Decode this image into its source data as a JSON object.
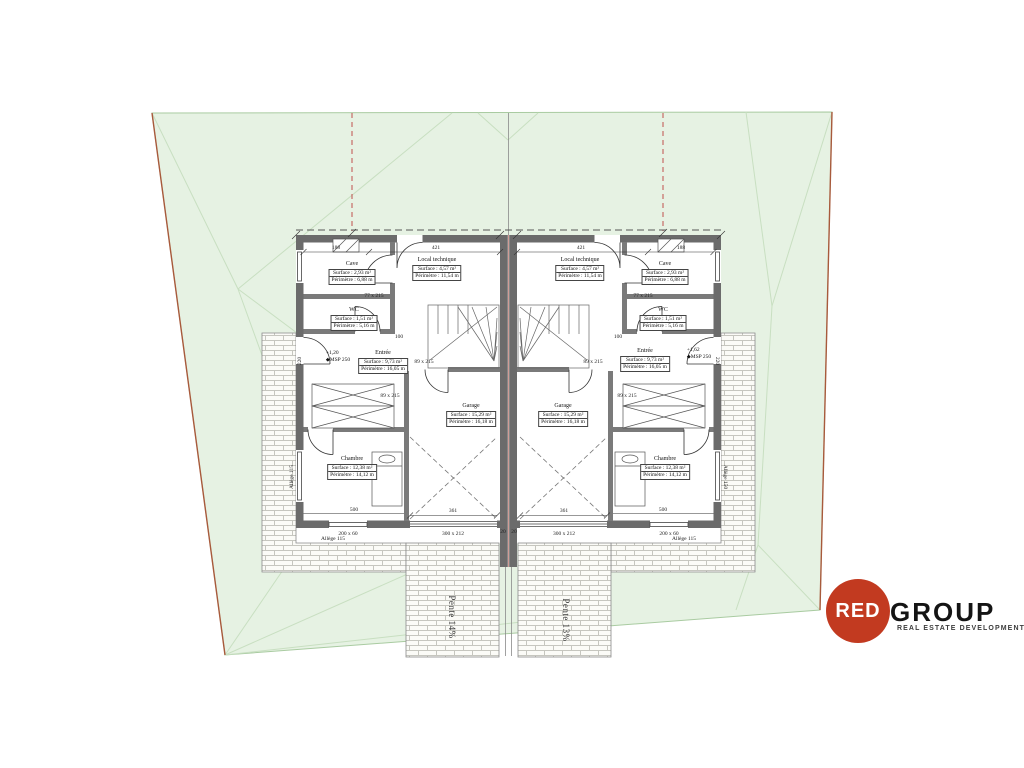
{
  "colors": {
    "plot_fill": "#e6f2e3",
    "plot_edge": "#a9cba1",
    "triangulation": "#c8dfc1",
    "boundary_line": "#a85a3c",
    "setback_red": "#c0504d",
    "wall_gray": "#6b6b6b",
    "brick_line": "#c6c6bf",
    "logo_red": "#c23a20"
  },
  "rooms": {
    "cave": {
      "name": "Cave",
      "surface": "Surface : 2,93 m²",
      "perimetre": "Périmètre : 6,88 m"
    },
    "local": {
      "name": "Local technique",
      "surface": "Surface : 4,57 m²",
      "perimetre": "Périmètre : 11,54 m"
    },
    "wc": {
      "name": "WC",
      "surface": "Surface : 1,51 m²",
      "perimetre": "Périmètre : 5,16 m"
    },
    "entree": {
      "name": "Entrée",
      "surface": "Surface : 9,73 m²",
      "perimetre": "Périmètre : 16,05 m"
    },
    "garage": {
      "name": "Garage",
      "surface": "Surface : 15,29 m²",
      "perimetre": "Périmètre : 16,18 m"
    },
    "chambre": {
      "name": "Chambre",
      "surface": "Surface : 12,38 m²",
      "perimetre": "Périmètre : 14,12 m"
    }
  },
  "levels": {
    "left_value": "+1,20",
    "left_ref": "MSP 250",
    "right_value": "+1,62",
    "right_ref": "MSP 250"
  },
  "icons": {
    "level_marker": "◆"
  },
  "dims": {
    "d188": "188",
    "d421": "421",
    "door77": "77 x 215",
    "door89": "89 x 215",
    "d361": "361",
    "garage_door": "300 x 212",
    "d500": "500",
    "window": "200 x 60",
    "d100": "100",
    "d220": "220",
    "d20": "20",
    "allege115": "Allège 115",
    "allege150": "Allège 150"
  },
  "slopes": {
    "left": "Pente 14%",
    "right": "Pente 13%"
  },
  "logo": {
    "red": "RED",
    "group": "GROUP",
    "tagline": "REAL ESTATE DEVELOPMENT"
  }
}
